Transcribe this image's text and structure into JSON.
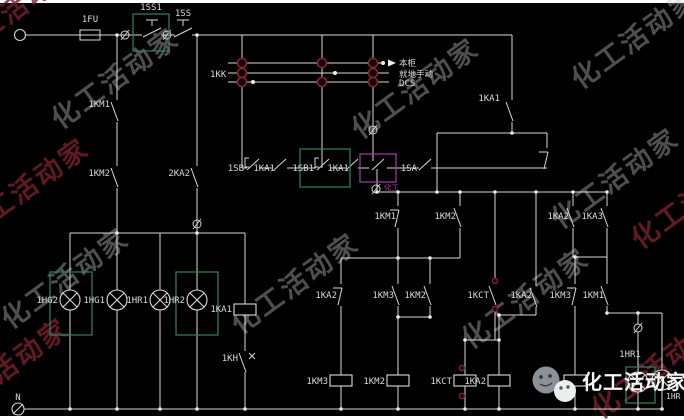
{
  "meta": {
    "bg": "#000000",
    "wire_color": "#d9d9d9",
    "label_color": "#d9d9d9",
    "teal_box_color": "#2f8172",
    "magenta_box_color": "#a93aa9",
    "maroon_ring_color": "#8a2433",
    "red_dot_color": "#7c2130",
    "watermark_gray": "#bdbdbd",
    "watermark_maroon": "#7c1f2c"
  },
  "schematic": {
    "selector_switch": {
      "name_label": "1KK",
      "position_labels": [
        "本柜",
        "就地手动",
        "DCS"
      ],
      "rows_y": [
        63,
        73,
        82
      ],
      "x_start": 228,
      "x_ends": [
        381,
        389,
        389
      ],
      "contact_circles": [
        [
          242,
          63
        ],
        [
          322,
          63
        ],
        [
          373,
          63
        ],
        [
          242,
          73
        ],
        [
          373,
          73
        ],
        [
          242,
          82
        ],
        [
          322,
          82
        ],
        [
          373,
          82
        ]
      ],
      "white_dots": [
        [
          383,
          63
        ],
        [
          335,
          73
        ],
        [
          253,
          82
        ]
      ],
      "arrow": {
        "x1": 381,
        "y": 63,
        "tipx": 396
      }
    },
    "labels": [
      {
        "t": "1FU",
        "x": 90,
        "y": 22,
        "a": "m"
      },
      {
        "t": "1SS1",
        "x": 151,
        "y": 10,
        "a": "m"
      },
      {
        "t": "1SS",
        "x": 183,
        "y": 16,
        "a": "m"
      },
      {
        "t": "1KK",
        "x": 210,
        "y": 77,
        "a": "s"
      },
      {
        "t": "本柜",
        "x": 399,
        "y": 66,
        "a": "s",
        "fs": 8.5
      },
      {
        "t": "就地手动",
        "x": 399,
        "y": 77,
        "a": "s",
        "fs": 8.5
      },
      {
        "t": "DCS",
        "x": 399,
        "y": 86,
        "a": "s"
      },
      {
        "t": "1KA1",
        "x": 500,
        "y": 101,
        "a": "e"
      },
      {
        "t": "1KM1",
        "x": 110,
        "y": 107,
        "a": "e"
      },
      {
        "t": "1KM2",
        "x": 110,
        "y": 176,
        "a": "e"
      },
      {
        "t": "2KA2",
        "x": 190,
        "y": 176,
        "a": "e"
      },
      {
        "t": "1SB",
        "x": 244,
        "y": 171,
        "a": "e"
      },
      {
        "t": "1KA1",
        "x": 275,
        "y": 171,
        "a": "e"
      },
      {
        "t": "1SB1",
        "x": 314,
        "y": 171,
        "a": "e"
      },
      {
        "t": "1KA1",
        "x": 349,
        "y": 171,
        "a": "e"
      },
      {
        "t": "1SA",
        "x": 417,
        "y": 171,
        "a": "e"
      },
      {
        "t": "1KM1",
        "x": 396,
        "y": 219,
        "a": "e"
      },
      {
        "t": "1KM2",
        "x": 456,
        "y": 219,
        "a": "e"
      },
      {
        "t": "1KA2",
        "x": 569,
        "y": 219,
        "a": "e"
      },
      {
        "t": "1KA3",
        "x": 603,
        "y": 219,
        "a": "e"
      },
      {
        "t": "1KA2",
        "x": 337,
        "y": 298,
        "a": "e"
      },
      {
        "t": "1KM3",
        "x": 394,
        "y": 298,
        "a": "e"
      },
      {
        "t": "1KM2",
        "x": 426,
        "y": 298,
        "a": "e"
      },
      {
        "t": "1KCT",
        "x": 489,
        "y": 298,
        "a": "e"
      },
      {
        "t": "1KA2",
        "x": 532,
        "y": 298,
        "a": "e"
      },
      {
        "t": "1KM3",
        "x": 571,
        "y": 298,
        "a": "e"
      },
      {
        "t": "1KM1",
        "x": 604,
        "y": 298,
        "a": "e"
      },
      {
        "t": "1HG2",
        "x": 58,
        "y": 303,
        "a": "e"
      },
      {
        "t": "1HG1",
        "x": 105,
        "y": 303,
        "a": "e"
      },
      {
        "t": "1HR1",
        "x": 148,
        "y": 303,
        "a": "e"
      },
      {
        "t": "1HR2",
        "x": 185,
        "y": 303,
        "a": "e"
      },
      {
        "t": "1KA1",
        "x": 232,
        "y": 312,
        "a": "e"
      },
      {
        "t": "1KH",
        "x": 238,
        "y": 361,
        "a": "e"
      },
      {
        "t": "1KM3",
        "x": 328,
        "y": 384,
        "a": "e"
      },
      {
        "t": "1KM2",
        "x": 385,
        "y": 384,
        "a": "e"
      },
      {
        "t": "1KCT",
        "x": 452,
        "y": 384,
        "a": "e"
      },
      {
        "t": "1KA2",
        "x": 486,
        "y": 384,
        "a": "e"
      },
      {
        "t": "1HR1",
        "x": 630,
        "y": 357,
        "a": "m"
      },
      {
        "t": "1HR",
        "x": 666,
        "y": 399,
        "a": "s",
        "fs": 8
      },
      {
        "t": "N",
        "x": 18,
        "y": 400,
        "a": "m"
      },
      {
        "t": "化工",
        "x": 384,
        "y": 190,
        "a": "s",
        "fs": 7.5,
        "c": "#a93aa9"
      }
    ],
    "wires": [
      [
        26,
        35,
        142,
        35
      ],
      [
        161,
        35,
        175,
        35
      ],
      [
        192,
        35,
        512,
        35
      ],
      [
        117,
        35,
        117,
        100
      ],
      [
        117,
        122,
        117,
        166
      ],
      [
        117,
        188,
        117,
        233
      ],
      [
        197,
        35,
        197,
        166
      ],
      [
        197,
        188,
        197,
        233
      ],
      [
        242,
        35,
        242,
        168
      ],
      [
        322,
        35,
        322,
        168
      ],
      [
        373,
        35,
        373,
        161
      ],
      [
        512,
        35,
        512,
        100
      ],
      [
        512,
        122,
        512,
        133
      ],
      [
        437,
        133,
        547,
        133
      ],
      [
        437,
        133,
        437,
        192
      ],
      [
        547,
        133,
        547,
        148
      ],
      [
        242,
        168,
        247,
        168
      ],
      [
        259,
        168,
        273,
        168
      ],
      [
        287,
        168,
        316,
        168
      ],
      [
        330,
        168,
        346,
        168
      ],
      [
        358,
        168,
        369,
        168
      ],
      [
        387,
        168,
        419,
        168
      ],
      [
        431,
        168,
        547,
        168
      ],
      [
        377,
        169,
        377,
        192
      ],
      [
        376,
        192,
        608,
        192
      ],
      [
        398,
        192,
        398,
        206
      ],
      [
        398,
        228,
        398,
        258
      ],
      [
        460,
        192,
        460,
        206
      ],
      [
        460,
        228,
        460,
        258
      ],
      [
        573,
        192,
        573,
        206
      ],
      [
        573,
        228,
        573,
        257
      ],
      [
        607,
        192,
        607,
        206
      ],
      [
        607,
        228,
        607,
        257
      ],
      [
        495,
        192,
        495,
        284
      ],
      [
        495,
        306,
        495,
        340
      ],
      [
        536,
        192,
        536,
        286
      ],
      [
        536,
        307,
        536,
        315
      ],
      [
        499,
        315,
        536,
        315
      ],
      [
        499,
        315,
        499,
        340
      ],
      [
        465,
        340,
        499,
        340
      ],
      [
        465,
        340,
        465,
        375
      ],
      [
        499,
        340,
        499,
        375
      ],
      [
        341,
        258,
        460,
        258
      ],
      [
        341,
        258,
        341,
        284
      ],
      [
        341,
        306,
        341,
        375
      ],
      [
        398,
        258,
        398,
        284
      ],
      [
        398,
        306,
        398,
        317
      ],
      [
        430,
        258,
        430,
        284
      ],
      [
        430,
        306,
        430,
        317
      ],
      [
        398,
        317,
        430,
        317
      ],
      [
        398,
        317,
        398,
        375
      ],
      [
        573,
        257,
        607,
        257
      ],
      [
        575,
        257,
        575,
        284
      ],
      [
        575,
        306,
        575,
        375
      ],
      [
        607,
        257,
        607,
        284
      ],
      [
        607,
        306,
        607,
        313
      ],
      [
        607,
        313,
        662,
        313
      ],
      [
        638,
        313,
        638,
        324
      ],
      [
        638,
        332,
        638,
        372
      ],
      [
        638,
        392,
        638,
        409
      ],
      [
        662,
        313,
        662,
        370
      ],
      [
        662,
        390,
        662,
        409
      ],
      [
        70,
        233,
        245,
        233
      ],
      [
        70,
        233,
        70,
        290
      ],
      [
        70,
        310,
        70,
        409
      ],
      [
        117,
        233,
        117,
        290
      ],
      [
        117,
        310,
        117,
        409
      ],
      [
        160,
        233,
        160,
        290
      ],
      [
        160,
        310,
        160,
        409
      ],
      [
        197,
        233,
        197,
        290
      ],
      [
        197,
        310,
        197,
        409
      ],
      [
        245,
        233,
        245,
        304
      ],
      [
        245,
        315,
        245,
        351
      ],
      [
        245,
        372,
        245,
        409
      ],
      [
        341,
        386,
        341,
        409
      ],
      [
        398,
        386,
        398,
        409
      ],
      [
        465,
        386,
        465,
        409
      ],
      [
        499,
        386,
        499,
        409
      ],
      [
        575,
        386,
        575,
        409
      ],
      [
        24,
        409,
        662,
        409
      ]
    ],
    "contacts": [
      {
        "x": 117,
        "y": 100,
        "k": "no"
      },
      {
        "x": 117,
        "y": 166,
        "k": "no"
      },
      {
        "x": 197,
        "y": 166,
        "k": "no"
      },
      {
        "x": 512,
        "y": 100,
        "k": "no"
      },
      {
        "x": 547,
        "y": 148,
        "k": "nc"
      },
      {
        "x": 398,
        "y": 206,
        "k": "nc"
      },
      {
        "x": 460,
        "y": 206,
        "k": "no"
      },
      {
        "x": 573,
        "y": 206,
        "k": "no"
      },
      {
        "x": 607,
        "y": 206,
        "k": "no"
      },
      {
        "x": 341,
        "y": 284,
        "k": "nc"
      },
      {
        "x": 398,
        "y": 284,
        "k": "no"
      },
      {
        "x": 430,
        "y": 284,
        "k": "no"
      },
      {
        "x": 495,
        "y": 284,
        "k": "no"
      },
      {
        "x": 536,
        "y": 286,
        "k": "no"
      },
      {
        "x": 575,
        "y": 284,
        "k": "nc"
      },
      {
        "x": 607,
        "y": 284,
        "k": "no"
      },
      {
        "x": 245,
        "y": 351,
        "k": "th"
      }
    ],
    "buttons_x": [
      253,
      323
    ],
    "hblades_x": [
      280,
      352,
      378,
      425
    ],
    "branch_row_y": 168,
    "knives_x": [
      152,
      183
    ],
    "fuse": {
      "x": 90,
      "y": 35,
      "w": 20,
      "h": 10
    },
    "lamps": [
      {
        "x": 70,
        "y": 300
      },
      {
        "x": 117,
        "y": 300
      },
      {
        "x": 160,
        "y": 300
      },
      {
        "x": 197,
        "y": 300
      },
      {
        "x": 638,
        "y": 382
      },
      {
        "x": 662,
        "y": 380
      }
    ],
    "coils": [
      {
        "x": 245,
        "y": 304
      },
      {
        "x": 341,
        "y": 375
      },
      {
        "x": 398,
        "y": 375
      },
      {
        "x": 465,
        "y": 375
      },
      {
        "x": 499,
        "y": 375
      },
      {
        "x": 575,
        "y": 375
      }
    ],
    "phi_marks": [
      [
        125,
        35
      ],
      [
        167,
        35
      ],
      [
        373,
        130
      ],
      [
        197,
        224
      ],
      [
        638,
        328
      ],
      [
        376,
        189
      ]
    ],
    "junction_dots": [
      [
        117,
        35
      ],
      [
        197,
        35
      ],
      [
        512,
        133
      ],
      [
        377,
        192
      ],
      [
        398,
        192
      ],
      [
        437,
        192
      ],
      [
        460,
        192
      ],
      [
        495,
        192
      ],
      [
        536,
        192
      ],
      [
        573,
        192
      ],
      [
        607,
        192
      ],
      [
        398,
        258
      ],
      [
        430,
        258
      ],
      [
        398,
        317
      ],
      [
        430,
        317
      ],
      [
        499,
        315
      ],
      [
        465,
        340
      ],
      [
        499,
        340
      ],
      [
        575,
        257
      ],
      [
        607,
        313
      ],
      [
        638,
        313
      ],
      [
        117,
        233
      ],
      [
        197,
        233
      ],
      [
        70,
        409
      ],
      [
        117,
        409
      ],
      [
        160,
        409
      ],
      [
        197,
        409
      ],
      [
        245,
        409
      ],
      [
        341,
        409
      ],
      [
        398,
        409
      ],
      [
        465,
        409
      ],
      [
        499,
        409
      ],
      [
        575,
        409
      ],
      [
        638,
        409
      ],
      [
        662,
        409
      ]
    ],
    "red_dots": [
      [
        495,
        281
      ],
      [
        495,
        309
      ],
      [
        462,
        368
      ],
      [
        462,
        396
      ]
    ],
    "teal_boxes": [
      [
        133,
        14,
        36,
        37
      ],
      [
        300,
        149,
        50,
        38
      ],
      [
        50,
        272,
        42,
        63
      ],
      [
        176,
        272,
        42,
        63
      ],
      [
        626,
        367,
        29,
        36
      ]
    ],
    "magenta_boxes": [
      [
        360,
        154,
        36,
        28
      ]
    ],
    "terminal": {
      "x": 20,
      "y": 35
    },
    "n_terminal": {
      "x": 18,
      "y": 409,
      "label": "N"
    },
    "watermarks": [
      {
        "x": 60,
        "y": 130,
        "c": "gray"
      },
      {
        "x": 10,
        "y": 330,
        "c": "gray"
      },
      {
        "x": 240,
        "y": 335,
        "c": "gray"
      },
      {
        "x": 360,
        "y": 140,
        "c": "gray"
      },
      {
        "x": 470,
        "y": 350,
        "c": "gray"
      },
      {
        "x": 560,
        "y": 230,
        "c": "gray"
      },
      {
        "x": 580,
        "y": 90,
        "c": "gray"
      },
      {
        "x": -40,
        "y": 60,
        "c": "maroon"
      },
      {
        "x": -50,
        "y": 420,
        "c": "maroon"
      },
      {
        "x": 600,
        "y": 420,
        "c": "maroon"
      },
      {
        "x": 640,
        "y": 250,
        "c": "maroon"
      },
      {
        "x": -30,
        "y": 240,
        "c": "maroon"
      }
    ],
    "watermark_text": "化工活动家",
    "logo": {
      "text": "化工活动家",
      "icon": "wechat-bubbles-icon"
    }
  }
}
